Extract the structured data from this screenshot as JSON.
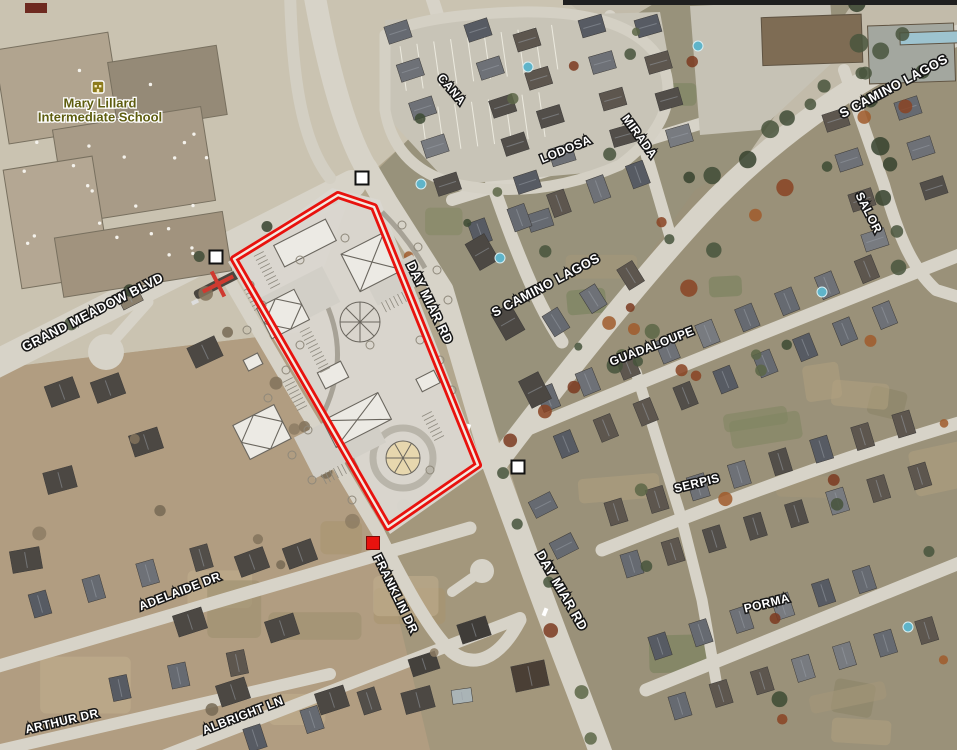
{
  "map": {
    "imagery": "satellite",
    "poi": {
      "line1": "Mary Lillard",
      "line2": "Intermediate School",
      "x": 100,
      "y": 104,
      "text_color": "#5e5d10",
      "icon": "school-icon",
      "icon_color": "#8d7b1d"
    },
    "street_labels": [
      {
        "text": "GRAND MEADOW BLVD",
        "x": 93,
        "y": 313,
        "rot": -27,
        "size": 13
      },
      {
        "text": "DAY MIAR RD",
        "x": 429,
        "y": 303,
        "rot": 64,
        "size": 13
      },
      {
        "text": "DAY MIAR RD",
        "x": 561,
        "y": 591,
        "rot": 60,
        "size": 13
      },
      {
        "text": "S CAMINO LAGOS",
        "x": 546,
        "y": 286,
        "rot": -28,
        "size": 13
      },
      {
        "text": "S CAMINO LAGOS",
        "x": 894,
        "y": 87,
        "rot": -28,
        "size": 13
      },
      {
        "text": "CANA",
        "x": 451,
        "y": 90,
        "rot": 50,
        "size": 12
      },
      {
        "text": "LODOSA",
        "x": 566,
        "y": 150,
        "rot": -22,
        "size": 12
      },
      {
        "text": "MIRADA",
        "x": 639,
        "y": 137,
        "rot": 54,
        "size": 12
      },
      {
        "text": "SALOR",
        "x": 868,
        "y": 213,
        "rot": 63,
        "size": 12
      },
      {
        "text": "GUADALOUPE",
        "x": 652,
        "y": 347,
        "rot": -21,
        "size": 12
      },
      {
        "text": "SERPIS",
        "x": 697,
        "y": 484,
        "rot": -14,
        "size": 12
      },
      {
        "text": "PORMA",
        "x": 767,
        "y": 604,
        "rot": -14,
        "size": 12
      },
      {
        "text": "ADELAIDE DR",
        "x": 180,
        "y": 592,
        "rot": -21,
        "size": 12
      },
      {
        "text": "ARTHUR DR",
        "x": 62,
        "y": 722,
        "rot": -13,
        "size": 12
      },
      {
        "text": "ALBRIGHT LN",
        "x": 243,
        "y": 716,
        "rot": -21,
        "size": 12
      },
      {
        "text": "FRANKLIN DR",
        "x": 395,
        "y": 594,
        "rot": 64,
        "size": 12
      }
    ],
    "site_outline": {
      "color": "#e8120e",
      "inner_gap_color": "#f2eae1",
      "vertices": [
        [
          338,
          195
        ],
        [
          374,
          207
        ],
        [
          478,
          465
        ],
        [
          388,
          527
        ],
        [
          234,
          259
        ]
      ]
    },
    "markers": {
      "white_squares": [
        [
          362,
          178
        ],
        [
          216,
          257
        ],
        [
          518,
          467
        ]
      ],
      "white_square_size": 13,
      "red_square": [
        373,
        543
      ],
      "red_square_size": 13,
      "red_square_color": "#e8120e",
      "red_cross": {
        "x": 218,
        "y": 284,
        "rot": -27,
        "color": "#cf3a30"
      }
    },
    "letterbox_bar": {
      "x": 563,
      "y": 0,
      "w": 394,
      "h": 5,
      "color": "#1f1f1f"
    }
  }
}
